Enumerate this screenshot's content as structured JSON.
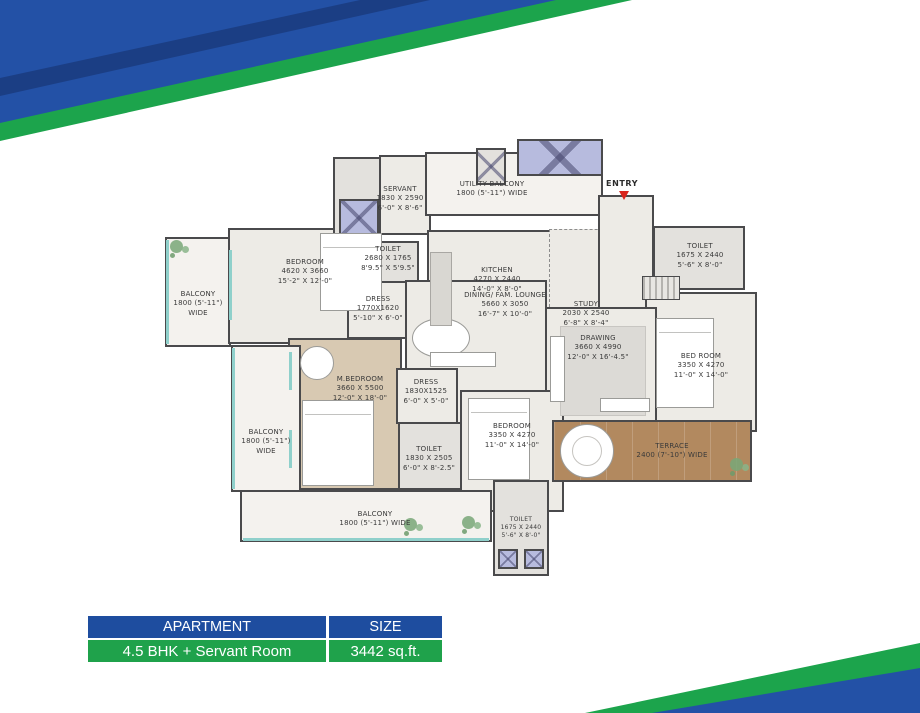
{
  "colors": {
    "banner_blue": "#2351a6",
    "banner_blue_dark": "#1a3f8c",
    "banner_green": "#1ca44c",
    "wall": "#4a4a4c",
    "floor": "#edebe6",
    "mbedroom_floor_beige": "#d8c9b2",
    "terrace_floor_wood": "#b2895f",
    "lift_lavender": "#b7bbde",
    "window_teal": "#8fd0cb",
    "entry_arrow_red": "#d9251d",
    "table_header_bg": "#1e4d9f",
    "table_value_bg": "#1fa24b"
  },
  "entry": {
    "label": "ENTRY"
  },
  "rooms": [
    {
      "name": "SERVANT",
      "mm": "1830 X 2590",
      "ft": "6'-0\" X 8'-6\""
    },
    {
      "name": "UTILITY BALCONY",
      "mm": "1800 (5'-11\") WIDE",
      "ft": ""
    },
    {
      "name": "TOILET",
      "mm": "2680 X 1765",
      "ft": "8'9.5\" X 5'9.5\""
    },
    {
      "name": "KITCHEN",
      "mm": "4270 X 2440",
      "ft": "14'-0\" X 8'-0\""
    },
    {
      "name": "STUDY",
      "mm": "2030 X 2540",
      "ft": "6'-8\" X 8'-4\""
    },
    {
      "name": "TOILET",
      "mm": "1675 X 2440",
      "ft": "5'-6\" X 8'-0\""
    },
    {
      "name": "BEDROOM",
      "mm": "4620 X 3660",
      "ft": "15'-2\" X 12'-0\""
    },
    {
      "name": "BALCONY",
      "mm": "1800 (5'-11\")",
      "ft": "WIDE"
    },
    {
      "name": "DRESS",
      "mm": "1770X1620",
      "ft": "5'-10\" X 6'-0\""
    },
    {
      "name": "DINING/ FAM. LOUNGE",
      "mm": "5660 X 3050",
      "ft": "16'-7\" X 10'-0\""
    },
    {
      "name": "DRAWING",
      "mm": "3660 X 4990",
      "ft": "12'-0\" X 16'-4.5\""
    },
    {
      "name": "BED ROOM",
      "mm": "3350 X 4270",
      "ft": "11'-0\" X 14'-0\""
    },
    {
      "name": "M.BEDROOM",
      "mm": "3660 X 5500",
      "ft": "12'-0\" X 18'-0\""
    },
    {
      "name": "DRESS",
      "mm": "1830X1525",
      "ft": "6'-0\" X 5'-0\""
    },
    {
      "name": "TOILET",
      "mm": "1830 X 2505",
      "ft": "6'-0\" X 8'-2.5\""
    },
    {
      "name": "BEDROOM",
      "mm": "3350 X 4270",
      "ft": "11'-0\" X 14'-0\""
    },
    {
      "name": "TERRACE",
      "mm": "2400 (7'-10\") WIDE",
      "ft": ""
    },
    {
      "name": "BALCONY",
      "mm": "1800 (5'-11\")",
      "ft": "WIDE"
    },
    {
      "name": "BALCONY",
      "mm": "1800 (5'-11\") WIDE",
      "ft": ""
    },
    {
      "name": "TOILET",
      "mm": "1675 X 2440",
      "ft": "5'-6\" X 8'-0\""
    }
  ],
  "table": {
    "headers": [
      "APARTMENT",
      "SIZE"
    ],
    "row": [
      "4.5 BHK + Servant Room",
      "3442 sq.ft."
    ]
  }
}
